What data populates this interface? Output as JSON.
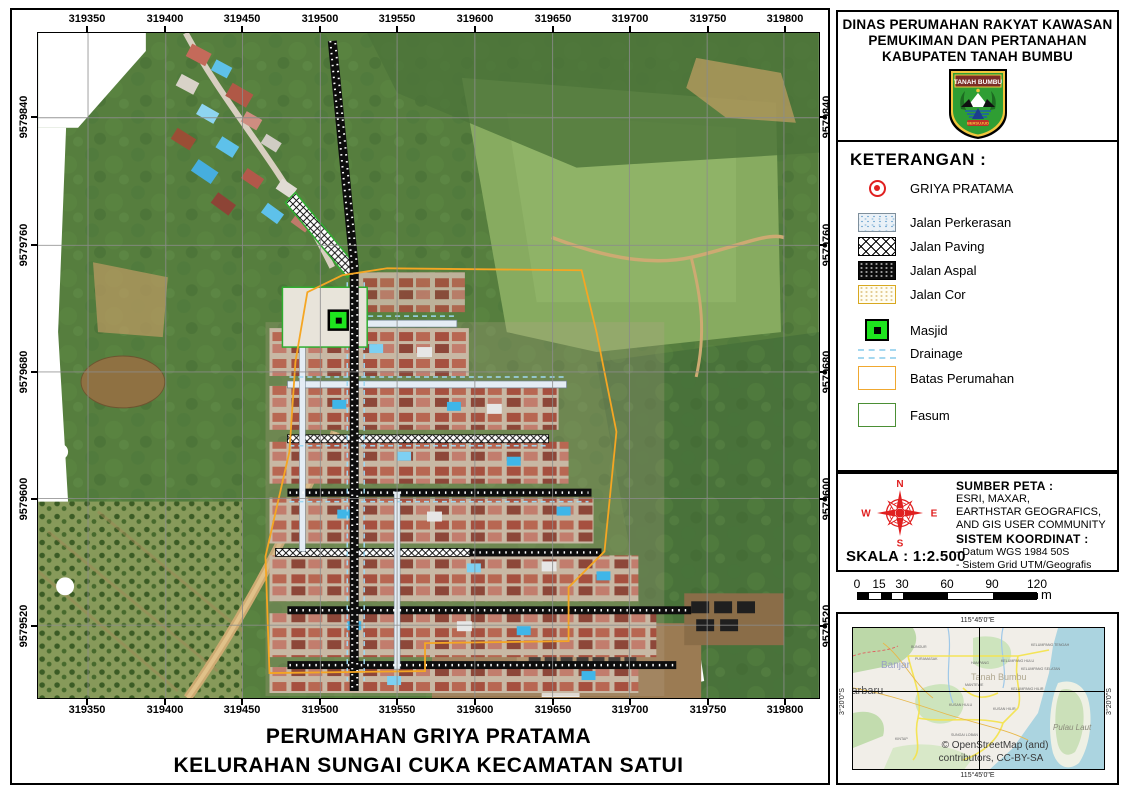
{
  "header": {
    "title_lines": [
      "DINAS PERUMAHAN RAKYAT KAWASAN",
      "PEMUKIMAN DAN PERTANAHAN",
      "KABUPATEN TANAH BUMBU"
    ],
    "logo": {
      "banner": "TANAH BUMBU",
      "motto": "BERSUJUD"
    }
  },
  "legend": {
    "title": "KETERANGAN :",
    "point_item": "GRIYA PRATAMA",
    "items": [
      "Jalan Perkerasan",
      "Jalan Paving",
      "Jalan Aspal",
      "Jalan Cor",
      "Masjid",
      "Drainage",
      "Batas Perumahan",
      "Fasum"
    ]
  },
  "compass": {
    "n": "N",
    "e": "E",
    "s": "S",
    "w": "W"
  },
  "source": {
    "title": "SUMBER PETA :",
    "lines": [
      "ESRI, MAXAR,",
      "EARTHSTAR GEOGRAFICS,",
      "AND GIS USER COMMUNITY"
    ],
    "coord_title": "SISTEM KOORDINAT :",
    "coord_lines": [
      "- Datum WGS 1984 50S",
      "- Sistem Grid UTM/Geografis"
    ]
  },
  "scale": {
    "label": "SKALA : 1:2.500",
    "bar_ticks": [
      "0",
      "15",
      "30",
      "60",
      "90",
      "120"
    ],
    "unit": "m"
  },
  "inset": {
    "top_label": "115°45'0\"E",
    "bottom_label": "115°45'0\"E",
    "left_label": "3°20'0\"S",
    "right_label": "3°20'0\"S",
    "credit_lines": [
      "© OpenStreetMap (and)",
      "contributors, CC-BY-SA"
    ],
    "places": [
      "Banjar",
      "jarbaru",
      "Tanah Bumbu",
      "Pulau Laut"
    ],
    "small_places": [
      "BUNGUR",
      "PURAMASAK",
      "HAMPANG",
      "KELUMPANG TENGAH",
      "KELUMPANG HULU",
      "KELUMPANG SELATAN",
      "MANTEWE",
      "KELUMPANG HILIR",
      "KUSAN HULU",
      "KUSAN HILIR",
      "SUNGAI LOBAN",
      "KINTAP"
    ]
  },
  "map": {
    "top_ticks": [
      "319350",
      "319400",
      "319450",
      "319500",
      "319550",
      "319600",
      "319650",
      "319700",
      "319750",
      "319800"
    ],
    "bottom_ticks": [
      "319350",
      "319400",
      "319450",
      "319500",
      "319550",
      "319600",
      "319650",
      "319700",
      "319750",
      "319800"
    ],
    "left_ticks": [
      "9579840",
      "9579760",
      "9579680",
      "9579600",
      "9579520"
    ],
    "right_ticks": [
      "9579840",
      "9579760",
      "9579680",
      "9579600",
      "9579520"
    ]
  },
  "footer": {
    "title_lines": [
      "PERUMAHAN GRIYA PRATAMA",
      "KELURAHAN SUNGAI CUKA KECAMATAN SATUI"
    ]
  },
  "colors": {
    "accent_red": "#e02020",
    "boundary_orange": "#f5a623",
    "fasum_green": "#3faa35",
    "masjid_green": "#1ee41e",
    "drainage_blue": "#a5d8f0"
  }
}
